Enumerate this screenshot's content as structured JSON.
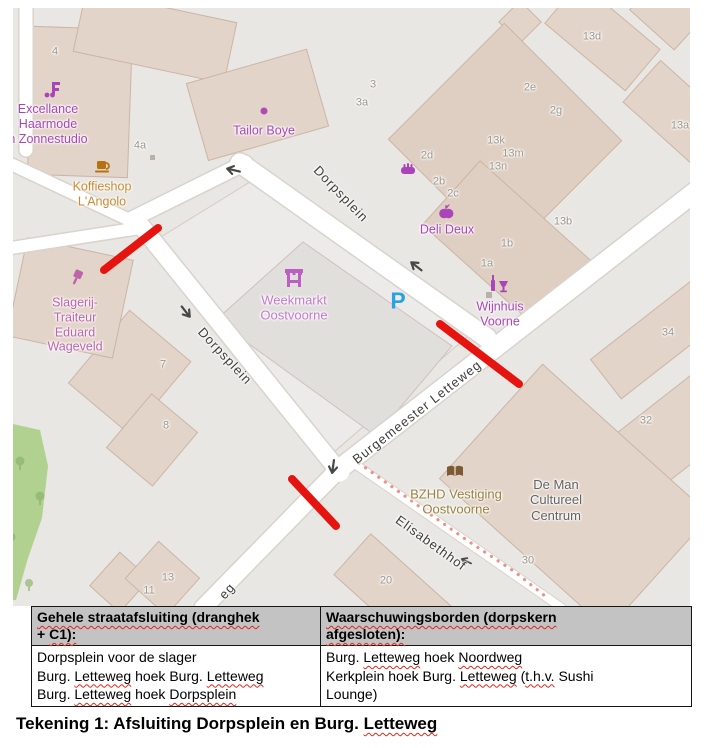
{
  "map": {
    "colors": {
      "closure_red": "#e5140e",
      "warning_dotted": "#ef8f86",
      "parking_blue": "#29a3e0",
      "poi_purple": "#ab44b8",
      "building_fill": "#e3d4c9",
      "road_white": "#ffffff",
      "park_green": "#b0d190"
    },
    "icons": [
      "hairdresser-icon",
      "coffee-cup-icon",
      "shop-dot-icon",
      "bakery-bread-icon",
      "greengrocer-apple-icon",
      "wine-icon",
      "marketplace-icon",
      "butcher-icon",
      "library-book-icon",
      "tree-icon",
      "building-marker-icon"
    ],
    "pois": [
      {
        "name": "excellance-haarmode",
        "x": 48,
        "y": 124,
        "cls": "purple",
        "lines": [
          "Excellance",
          "Haarmode",
          "n Zonnestudio"
        ]
      },
      {
        "name": "koffieshop-langolo",
        "x": 102,
        "y": 194,
        "cls": "amber",
        "lines": [
          "Koffieshop",
          "L'Angolo"
        ]
      },
      {
        "name": "tailor-boye",
        "x": 264,
        "y": 131,
        "cls": "purple",
        "lines": [
          "Tailor Boye"
        ]
      },
      {
        "name": "deli-deux",
        "x": 447,
        "y": 230,
        "cls": "purple",
        "lines": [
          "Deli Deux"
        ]
      },
      {
        "name": "wijnhuis-voorne",
        "x": 500,
        "y": 314,
        "cls": "purple",
        "lines": [
          "Wijnhuis",
          "Voorne"
        ]
      },
      {
        "name": "weekmarkt-oostvoorne",
        "x": 294,
        "y": 308,
        "cls": "violet",
        "lines": [
          "Weekmarkt",
          "Oostvoorne"
        ]
      },
      {
        "name": "slagerij-traiteur",
        "x": 75,
        "y": 325,
        "cls": "mauve",
        "lines": [
          "Slagerij-",
          "Traiteur",
          "Eduard",
          "Wageveld"
        ]
      },
      {
        "name": "bzhd-vestiging",
        "x": 456,
        "y": 502,
        "cls": "olive",
        "lines": [
          "BZHD Vestiging",
          "Oostvoorne"
        ]
      },
      {
        "name": "de-man-cultureel",
        "x": 556,
        "y": 500,
        "cls": "dark",
        "lines": [
          "De Man",
          "Cultureel",
          "Centrum"
        ]
      },
      {
        "name": "parking",
        "x": 398,
        "y": 301,
        "cls": "blue",
        "lines": [
          "P"
        ]
      }
    ],
    "street_labels": [
      {
        "text": "Dorpsplein",
        "x": 341,
        "y": 194,
        "rot": 46
      },
      {
        "text": "Dorpsplein",
        "x": 225,
        "y": 356,
        "rot": 47
      },
      {
        "text": "Burgemeester Letteweg",
        "x": 417,
        "y": 412,
        "rot": -38
      },
      {
        "text": "Elisabethhof",
        "x": 431,
        "y": 543,
        "rot": 36
      },
      {
        "text": "eg",
        "x": 227,
        "y": 591,
        "rot": -48
      }
    ],
    "house_numbers": [
      {
        "t": "4",
        "x": 55,
        "y": 52
      },
      {
        "t": "4a",
        "x": 140,
        "y": 146
      },
      {
        "t": "3",
        "x": 373,
        "y": 85
      },
      {
        "t": "3a",
        "x": 362,
        "y": 103
      },
      {
        "t": "13d",
        "x": 592,
        "y": 37
      },
      {
        "t": "2e",
        "x": 530,
        "y": 88
      },
      {
        "t": "2g",
        "x": 556,
        "y": 111
      },
      {
        "t": "13a",
        "x": 680,
        "y": 126
      },
      {
        "t": "13k",
        "x": 496,
        "y": 141
      },
      {
        "t": "13m",
        "x": 513,
        "y": 154
      },
      {
        "t": "13n",
        "x": 498,
        "y": 167
      },
      {
        "t": "2d",
        "x": 427,
        "y": 156
      },
      {
        "t": "2b",
        "x": 439,
        "y": 182
      },
      {
        "t": "2c",
        "x": 453,
        "y": 194
      },
      {
        "t": "13b",
        "x": 563,
        "y": 222
      },
      {
        "t": "1b",
        "x": 507,
        "y": 244
      },
      {
        "t": "1a",
        "x": 487,
        "y": 264
      },
      {
        "t": "34",
        "x": 668,
        "y": 333
      },
      {
        "t": "32",
        "x": 646,
        "y": 421
      },
      {
        "t": "7",
        "x": 163,
        "y": 365
      },
      {
        "t": "8",
        "x": 166,
        "y": 426
      },
      {
        "t": "30",
        "x": 528,
        "y": 561
      },
      {
        "t": "20",
        "x": 386,
        "y": 581
      },
      {
        "t": "13",
        "x": 168,
        "y": 578
      },
      {
        "t": "11",
        "x": 149,
        "y": 591
      }
    ]
  },
  "table": {
    "columns": [
      {
        "header_lines": [
          [
            {
              "t": "Gehele straatafsluiting (dranghek",
              "sq": true
            }
          ],
          [
            {
              "t": "+ ",
              "sq": false
            },
            {
              "t": "C1):",
              "sq": true
            }
          ]
        ],
        "body_lines": [
          [
            {
              "t": "Dorpsplein voor de slager",
              "sq": false
            }
          ],
          [
            {
              "t": "Burg. ",
              "sq": false
            },
            {
              "t": "Letteweg",
              "sq": true
            },
            {
              "t": " hoek Burg. ",
              "sq": false
            },
            {
              "t": "Letteweg",
              "sq": true
            }
          ],
          [
            {
              "t": "Burg. ",
              "sq": false
            },
            {
              "t": "Letteweg",
              "sq": true
            },
            {
              "t": " hoek ",
              "sq": false
            },
            {
              "t": "Dorpsplein",
              "sq": true
            }
          ]
        ]
      },
      {
        "header_lines": [
          [
            {
              "t": "Waarschuwingsborden (dorpskern",
              "sq": true
            }
          ],
          [
            {
              "t": "afgesloten):",
              "sq": true
            }
          ]
        ],
        "body_lines": [
          [
            {
              "t": "Burg. ",
              "sq": false
            },
            {
              "t": "Letteweg",
              "sq": true
            },
            {
              "t": " hoek ",
              "sq": false
            },
            {
              "t": "Noordweg",
              "sq": true
            }
          ],
          [
            {
              "t": "Kerkplein hoek Burg. ",
              "sq": false
            },
            {
              "t": "Letteweg",
              "sq": true
            },
            {
              "t": " (",
              "sq": false
            },
            {
              "t": "t.h.v.",
              "sq": true
            },
            {
              "t": " Sushi",
              "sq": false
            }
          ],
          [
            {
              "t": "Lounge)",
              "sq": false
            }
          ]
        ]
      }
    ]
  },
  "figure": {
    "caption_segments": [
      {
        "t": "Tekening 1: Afsluiting Dorpsplein en Burg. ",
        "sq": false
      },
      {
        "t": "Letteweg",
        "sq": true
      }
    ]
  }
}
